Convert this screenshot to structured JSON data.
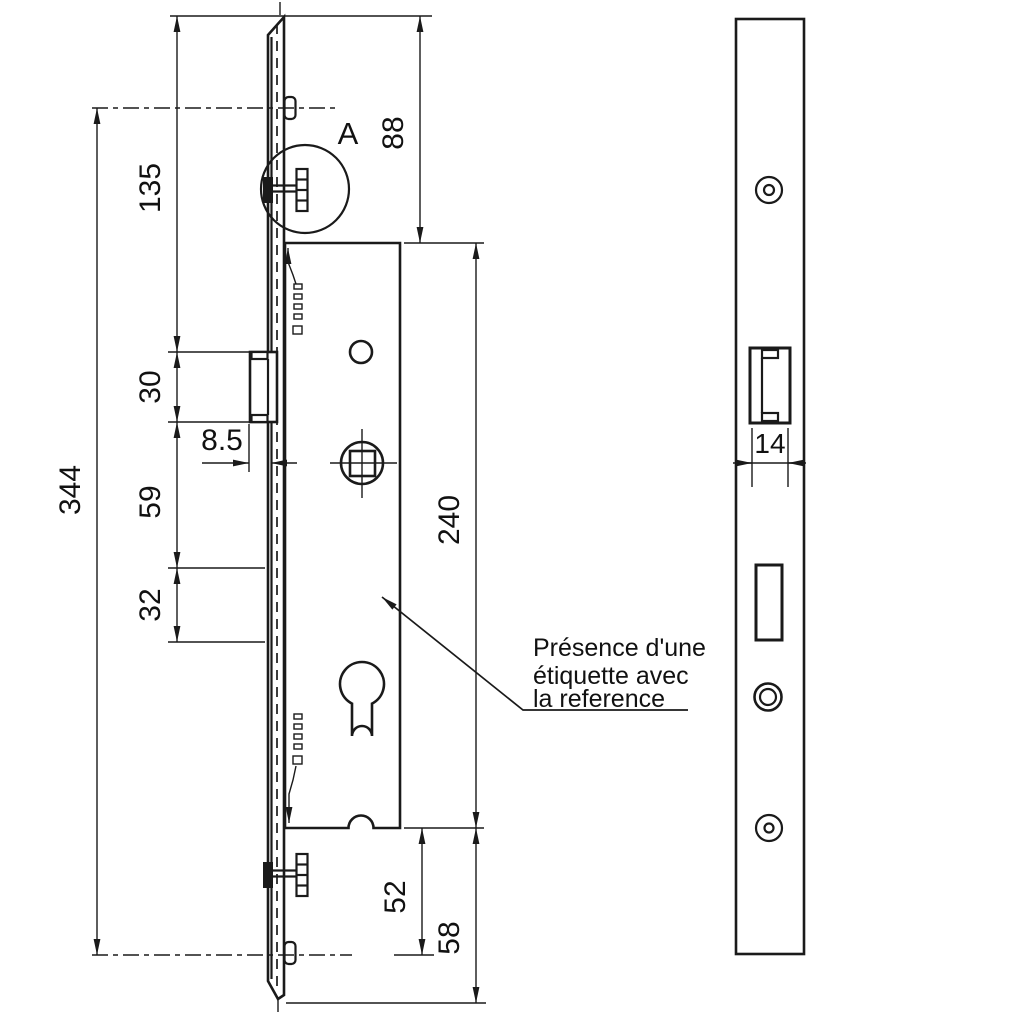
{
  "drawing_type": "technical-drawing-lock-mechanism",
  "note": {
    "line1": "Présence d'une",
    "line2": "étiquette avec",
    "line3": "la reference"
  },
  "detail_label": "A",
  "dims": {
    "overall_height": "344",
    "plate_top_to_latch": "135",
    "latch_height": "30",
    "latch_projection": "8.5",
    "latch_to_slot": "59",
    "slot_height": "32",
    "plate_top_to_case": "88",
    "case_height": "240",
    "case_to_bottom_axis": "52",
    "case_to_plate_end": "58",
    "faceplate_width": "14"
  },
  "colors": {
    "line": "#1a1a1a",
    "background": "#ffffff"
  }
}
